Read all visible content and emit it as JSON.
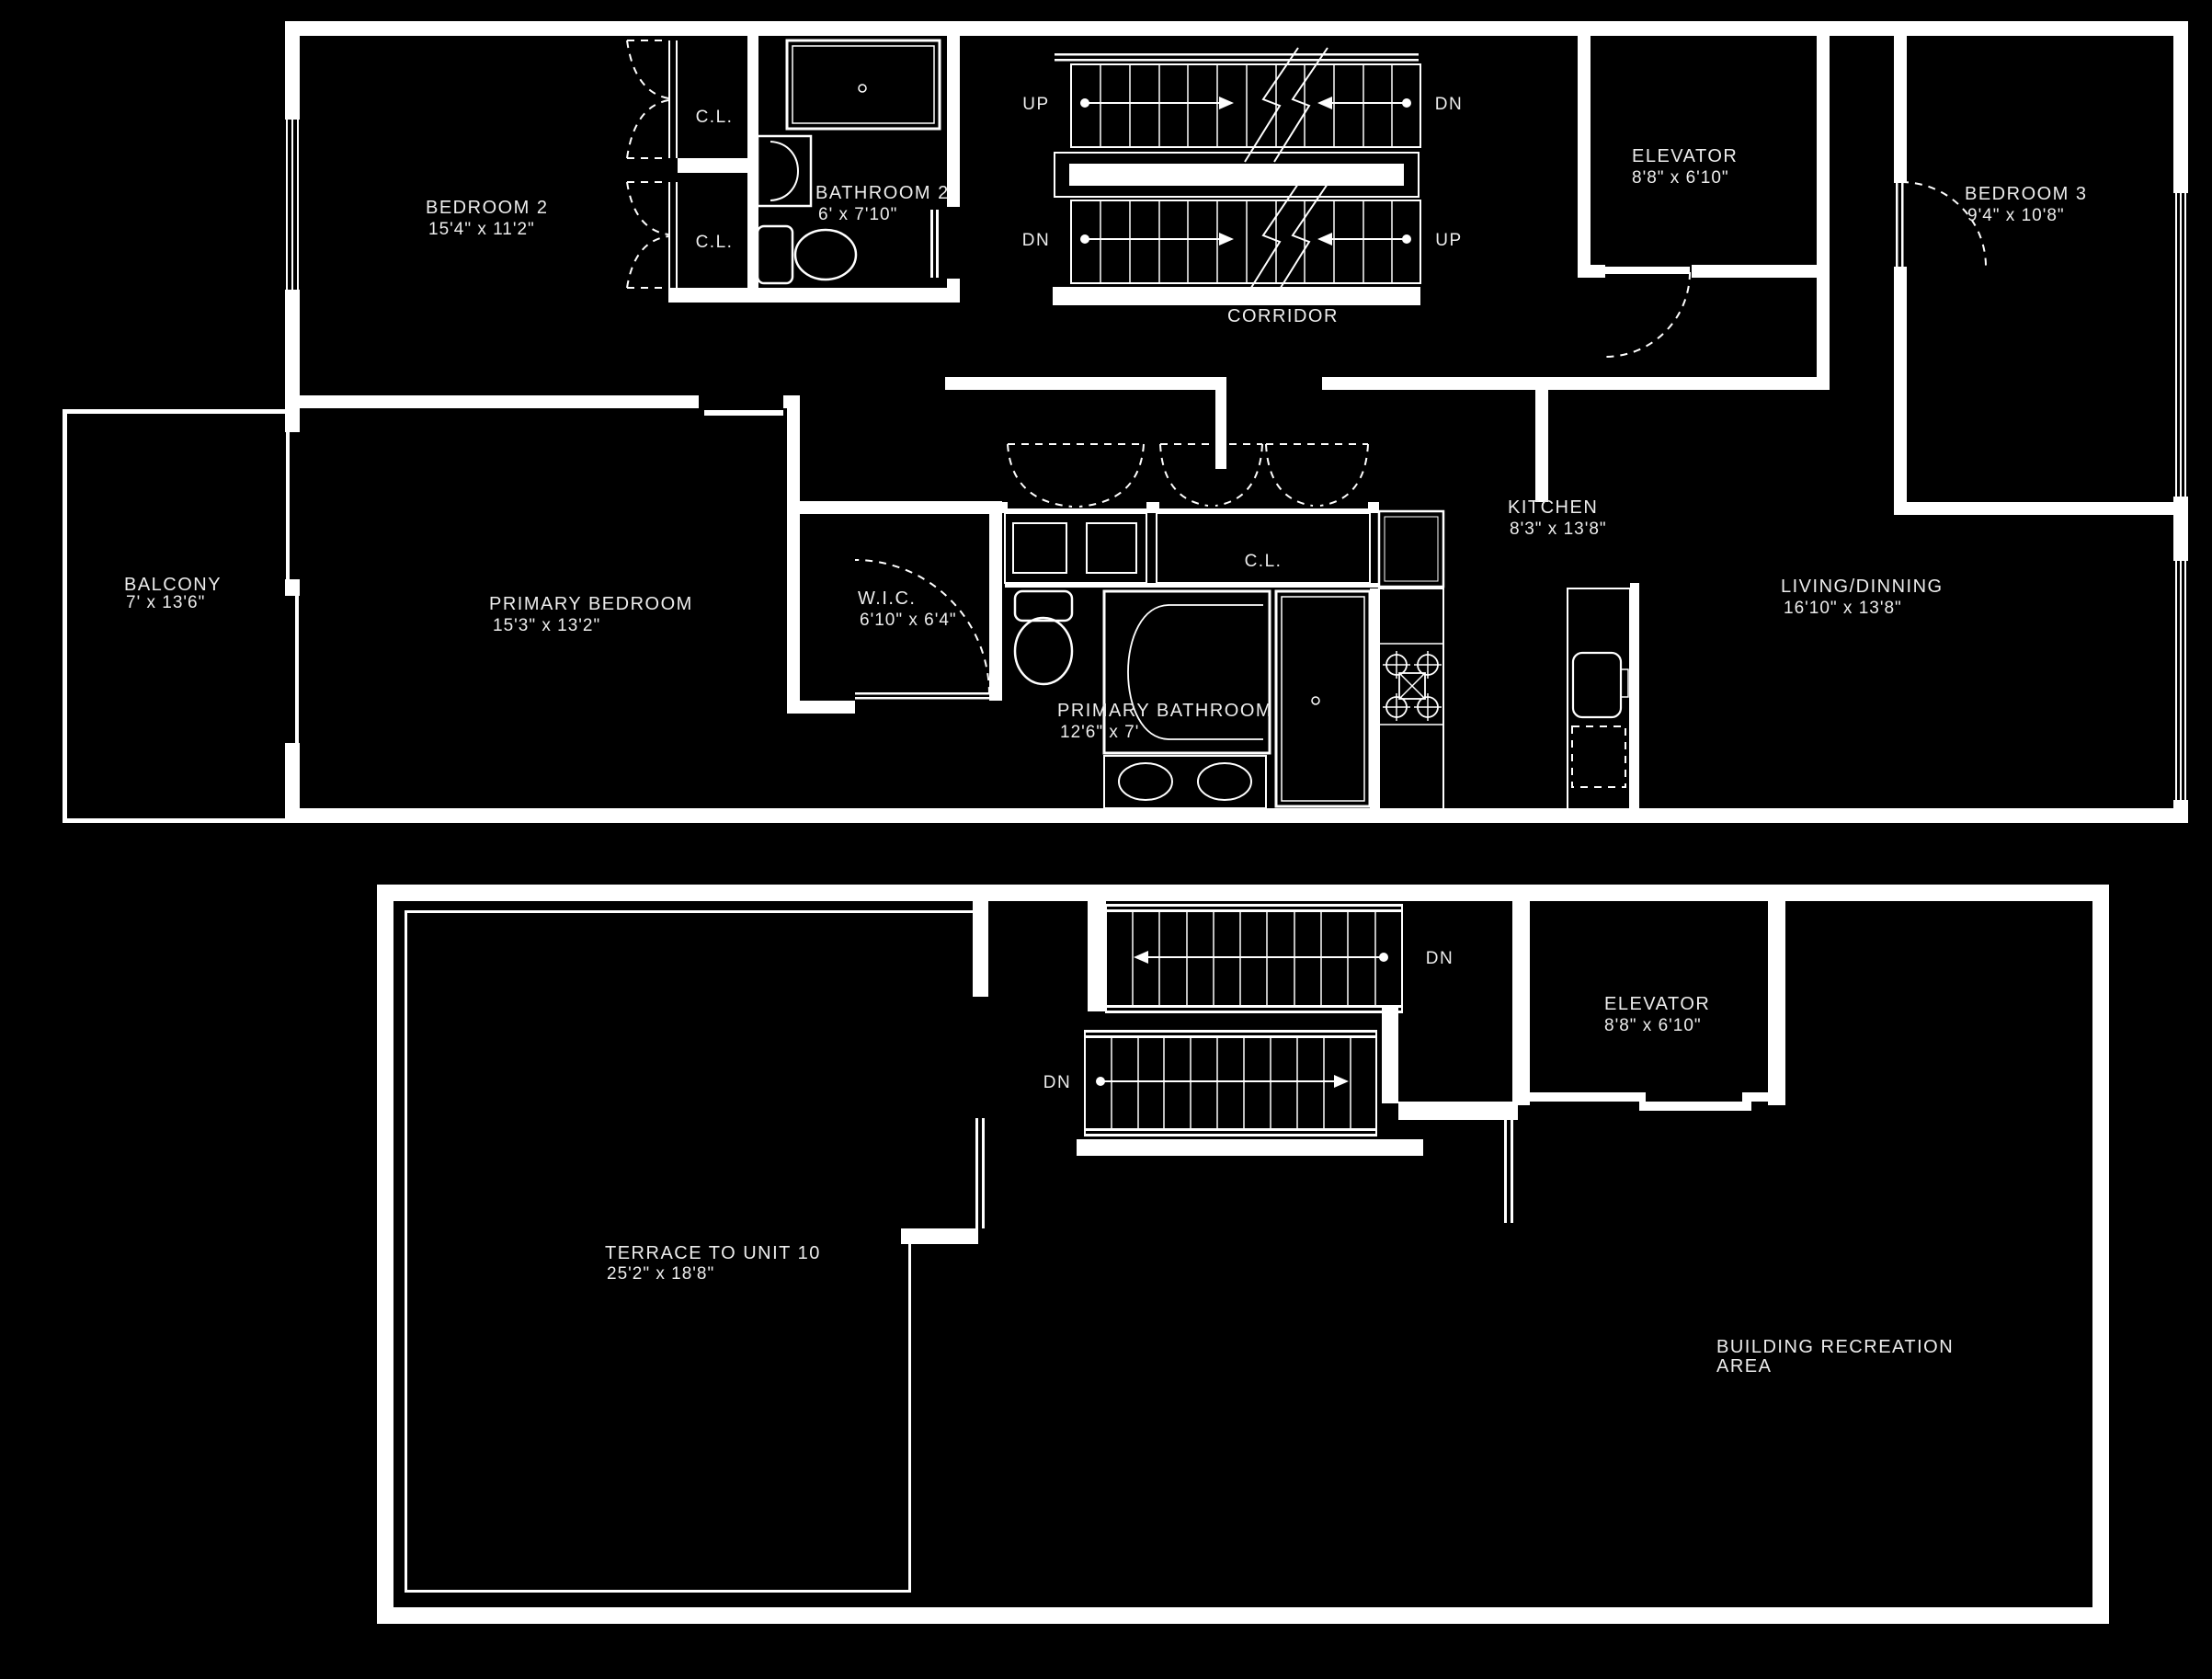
{
  "colors": {
    "background": "#000000",
    "lines": "#ffffff",
    "text": "#ededed"
  },
  "upper_floor": {
    "bedroom2": {
      "name": "BEDROOM 2",
      "dims": "15'4\" x 11'2\""
    },
    "closet_top": {
      "name": "C.L."
    },
    "closet_bottom": {
      "name": "C.L."
    },
    "bathroom2": {
      "name": "BATHROOM 2",
      "dims": "6' x 7'10\""
    },
    "stairs": {
      "up_left": "UP",
      "dn_right": "DN",
      "dn_left": "DN",
      "up_right": "UP"
    },
    "elevator": {
      "name": "ELEVATOR",
      "dims": "8'8\" x 6'10\""
    },
    "bedroom3": {
      "name": "BEDROOM 3",
      "dims": "9'4\" x 10'8\""
    },
    "corridor": {
      "name": "CORRIDOR"
    },
    "balcony": {
      "name": "BALCONY",
      "dims": "7' x 13'6\""
    },
    "primary_bedroom": {
      "name": "PRIMARY BEDROOM",
      "dims": "15'3\" x 13'2\""
    },
    "wic": {
      "name": "W.I.C.",
      "dims": "6'10\" x 6'4\""
    },
    "hall_closet": {
      "name": "C.L."
    },
    "kitchen": {
      "name": "KITCHEN",
      "dims": "8'3\" x 13'8\""
    },
    "living_dining": {
      "name": "LIVING/DINNING",
      "dims": "16'10\" x 13'8\""
    },
    "primary_bathroom": {
      "name": "PRIMARY BATHROOM",
      "dims": "12'6\" x 7'"
    }
  },
  "lower_floor": {
    "stairs": {
      "upper_flight_dn": "DN",
      "lower_flight_dn": "DN"
    },
    "elevator": {
      "name": "ELEVATOR",
      "dims": "8'8\" x 6'10\""
    },
    "terrace": {
      "name": "TERRACE TO UNIT 10",
      "dims": "25'2\" x 18'8\""
    },
    "recreation": {
      "name_line1": "BUILDING RECREATION",
      "name_line2": "AREA"
    }
  }
}
